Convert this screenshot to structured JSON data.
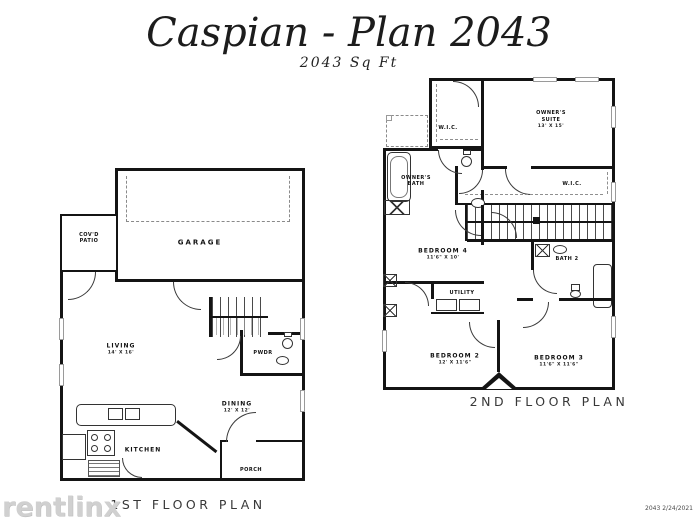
{
  "header": {
    "title": "Caspian - Plan 2043",
    "subtitle": "2043  Sq Ft"
  },
  "floor1": {
    "caption": "1ST FLOOR PLAN",
    "rooms": {
      "patio": {
        "name": "COV'D\nPATIO"
      },
      "garage": {
        "name": "GARAGE"
      },
      "living": {
        "name": "LIVING",
        "dims": "14' X 16'"
      },
      "pwdr": {
        "name": "PWDR"
      },
      "dining": {
        "name": "DINING",
        "dims": "12' X 12'"
      },
      "kitchen": {
        "name": "KITCHEN"
      },
      "porch": {
        "name": "PORCH"
      }
    }
  },
  "floor2": {
    "caption": "2ND FLOOR PLAN",
    "rooms": {
      "wic1": {
        "name": "W.I.C."
      },
      "suite": {
        "name": "OWNER'S\nSUITE",
        "dims": "13' X 15'"
      },
      "obath": {
        "name": "OWNER'S\nBATH"
      },
      "wic2": {
        "name": "W.I.C."
      },
      "bath2": {
        "name": "BATH 2"
      },
      "bed4": {
        "name": "BEDROOM 4",
        "dims": "11'6\" X 10'"
      },
      "utility": {
        "name": "UTILITY"
      },
      "bed2": {
        "name": "BEDROOM 2",
        "dims": "12' X 11'6\""
      },
      "bed3": {
        "name": "BEDROOM 3",
        "dims": "11'6\" X 11'6\""
      }
    }
  },
  "footer": {
    "watermark": "rentlinx",
    "revision": "2043 2/24/2021"
  },
  "colors": {
    "ink": "#141414",
    "watermark_gray": "#d0d0d0"
  },
  "icons": {
    "door-arc": "quarter-circle",
    "staircase": "striped-lines",
    "shower": "x-box",
    "bath-tub": "rounded-rect",
    "toilet": "circle-with-tank",
    "sink": "oval",
    "stove": "four-burner-circles",
    "washer-dryer": "paired-rects",
    "closet-rod": "dashed-line",
    "garage-door": "dashed-box"
  }
}
